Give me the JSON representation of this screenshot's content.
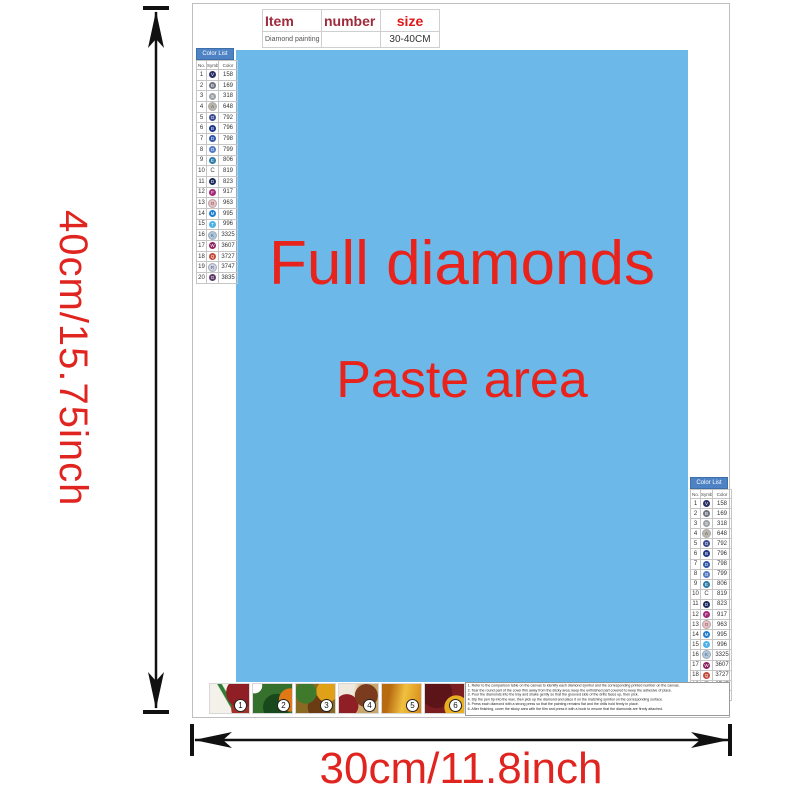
{
  "paste_area": {
    "line1": "Full diamonds",
    "line2": "Paste area",
    "bg_color": "#6cb8e9",
    "text_color": "#e8231c"
  },
  "dimensions": {
    "height_label": "40cm/15.75inch",
    "width_label": "30cm/11.8inch",
    "color": "#e02420"
  },
  "item_table": {
    "headers": [
      "Item",
      "number",
      "size"
    ],
    "row": {
      "item": "Diamond painting",
      "number": "",
      "size": "30-40CM"
    }
  },
  "color_list": {
    "title": "Color List",
    "columns": {
      "no": "No.",
      "symbol": "Symbol",
      "color": "Color"
    },
    "rows": [
      {
        "no": "1",
        "symbol": "V",
        "code": "158",
        "hex": "#2c3166",
        "light": false,
        "no_dot": false
      },
      {
        "no": "2",
        "symbol": "B",
        "code": "169",
        "hex": "#6f7480",
        "light": false,
        "no_dot": false
      },
      {
        "no": "3",
        "symbol": "S",
        "code": "318",
        "hex": "#9ba0a6",
        "light": false,
        "no_dot": false
      },
      {
        "no": "4",
        "symbol": "A",
        "code": "648",
        "hex": "#b8b5ab",
        "light": true,
        "no_dot": false
      },
      {
        "no": "5",
        "symbol": "O",
        "code": "792",
        "hex": "#3c4b8f",
        "light": false,
        "no_dot": false
      },
      {
        "no": "6",
        "symbol": "B",
        "code": "796",
        "hex": "#1f3787",
        "light": false,
        "no_dot": false
      },
      {
        "no": "7",
        "symbol": "D",
        "code": "798",
        "hex": "#2f55a7",
        "light": false,
        "no_dot": false
      },
      {
        "no": "8",
        "symbol": "O",
        "code": "799",
        "hex": "#5379c2",
        "light": false,
        "no_dot": false
      },
      {
        "no": "9",
        "symbol": "E",
        "code": "806",
        "hex": "#2b7ca6",
        "light": false,
        "no_dot": false
      },
      {
        "no": "10",
        "symbol": "C",
        "code": "819",
        "hex": "#f7e3e3",
        "light": true,
        "no_dot": true
      },
      {
        "no": "11",
        "symbol": "D",
        "code": "823",
        "hex": "#1d2a5e",
        "light": false,
        "no_dot": false
      },
      {
        "no": "12",
        "symbol": "F",
        "code": "917",
        "hex": "#a12a79",
        "light": false,
        "no_dot": false
      },
      {
        "no": "13",
        "symbol": "O",
        "code": "963",
        "hex": "#f0bcc0",
        "light": true,
        "no_dot": false
      },
      {
        "no": "14",
        "symbol": "M",
        "code": "995",
        "hex": "#1e7fd0",
        "light": false,
        "no_dot": false
      },
      {
        "no": "15",
        "symbol": "T",
        "code": "996",
        "hex": "#4fb0e8",
        "light": false,
        "no_dot": false
      },
      {
        "no": "16",
        "symbol": "K",
        "code": "3325",
        "hex": "#a9c8e4",
        "light": true,
        "no_dot": false
      },
      {
        "no": "17",
        "symbol": "W",
        "code": "3607",
        "hex": "#8e2460",
        "light": false,
        "no_dot": false
      },
      {
        "no": "18",
        "symbol": "Q",
        "code": "3727",
        "hex": "#c24a3a",
        "light": false,
        "no_dot": false
      },
      {
        "no": "19",
        "symbol": "R",
        "code": "3747",
        "hex": "#ccd2ec",
        "light": true,
        "no_dot": false
      },
      {
        "no": "20",
        "symbol": "G",
        "code": "3835",
        "hex": "#5e3a68",
        "light": false,
        "no_dot": false
      }
    ]
  },
  "steps": {
    "numbers": [
      "1",
      "2",
      "3",
      "4",
      "5",
      "6"
    ]
  },
  "instructions": {
    "lines": [
      "1. Refer to the comparison table on the canvas to identify each diamond symbol and the corresponding printed number on the canvas.",
      "2. Tear the round part of the cover film away from the sticky area; keep the unfinished part covered to keep the adhesive of place.",
      "3. Pour the diamonds into the tray and shake gently so that the grooved side of the drills faces up, then pick.",
      "4. Dip the pen tip into the wax, then pick up the diamond and place it on the matching symbol on the corresponding surface.",
      "5. Press each diamond with a strong press so that the painting remains flat and the drills hold firmly in place.",
      "6. After finishing, cover the sticky area with the film and press it with a book to ensure that the diamonds are firmly attached."
    ]
  }
}
